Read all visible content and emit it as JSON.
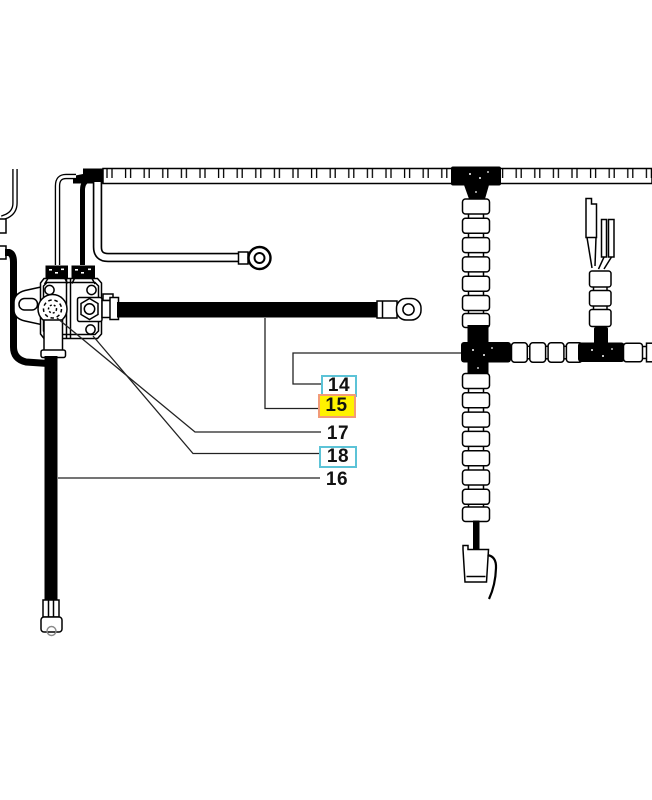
{
  "callouts": [
    {
      "label": "14",
      "style": "boxed"
    },
    {
      "label": "15",
      "style": "highlighted"
    },
    {
      "label": "17",
      "style": "plain"
    },
    {
      "label": "18",
      "style": "boxed"
    },
    {
      "label": "16",
      "style": "plain"
    }
  ],
  "highlighted_callout": "15",
  "colors": {
    "line": "#000000",
    "background": "#ffffff",
    "callout_text": "#111111",
    "box_border": "#5cc3d7",
    "highlight_bg": "#fff200",
    "highlight_border": "#f29b78"
  }
}
